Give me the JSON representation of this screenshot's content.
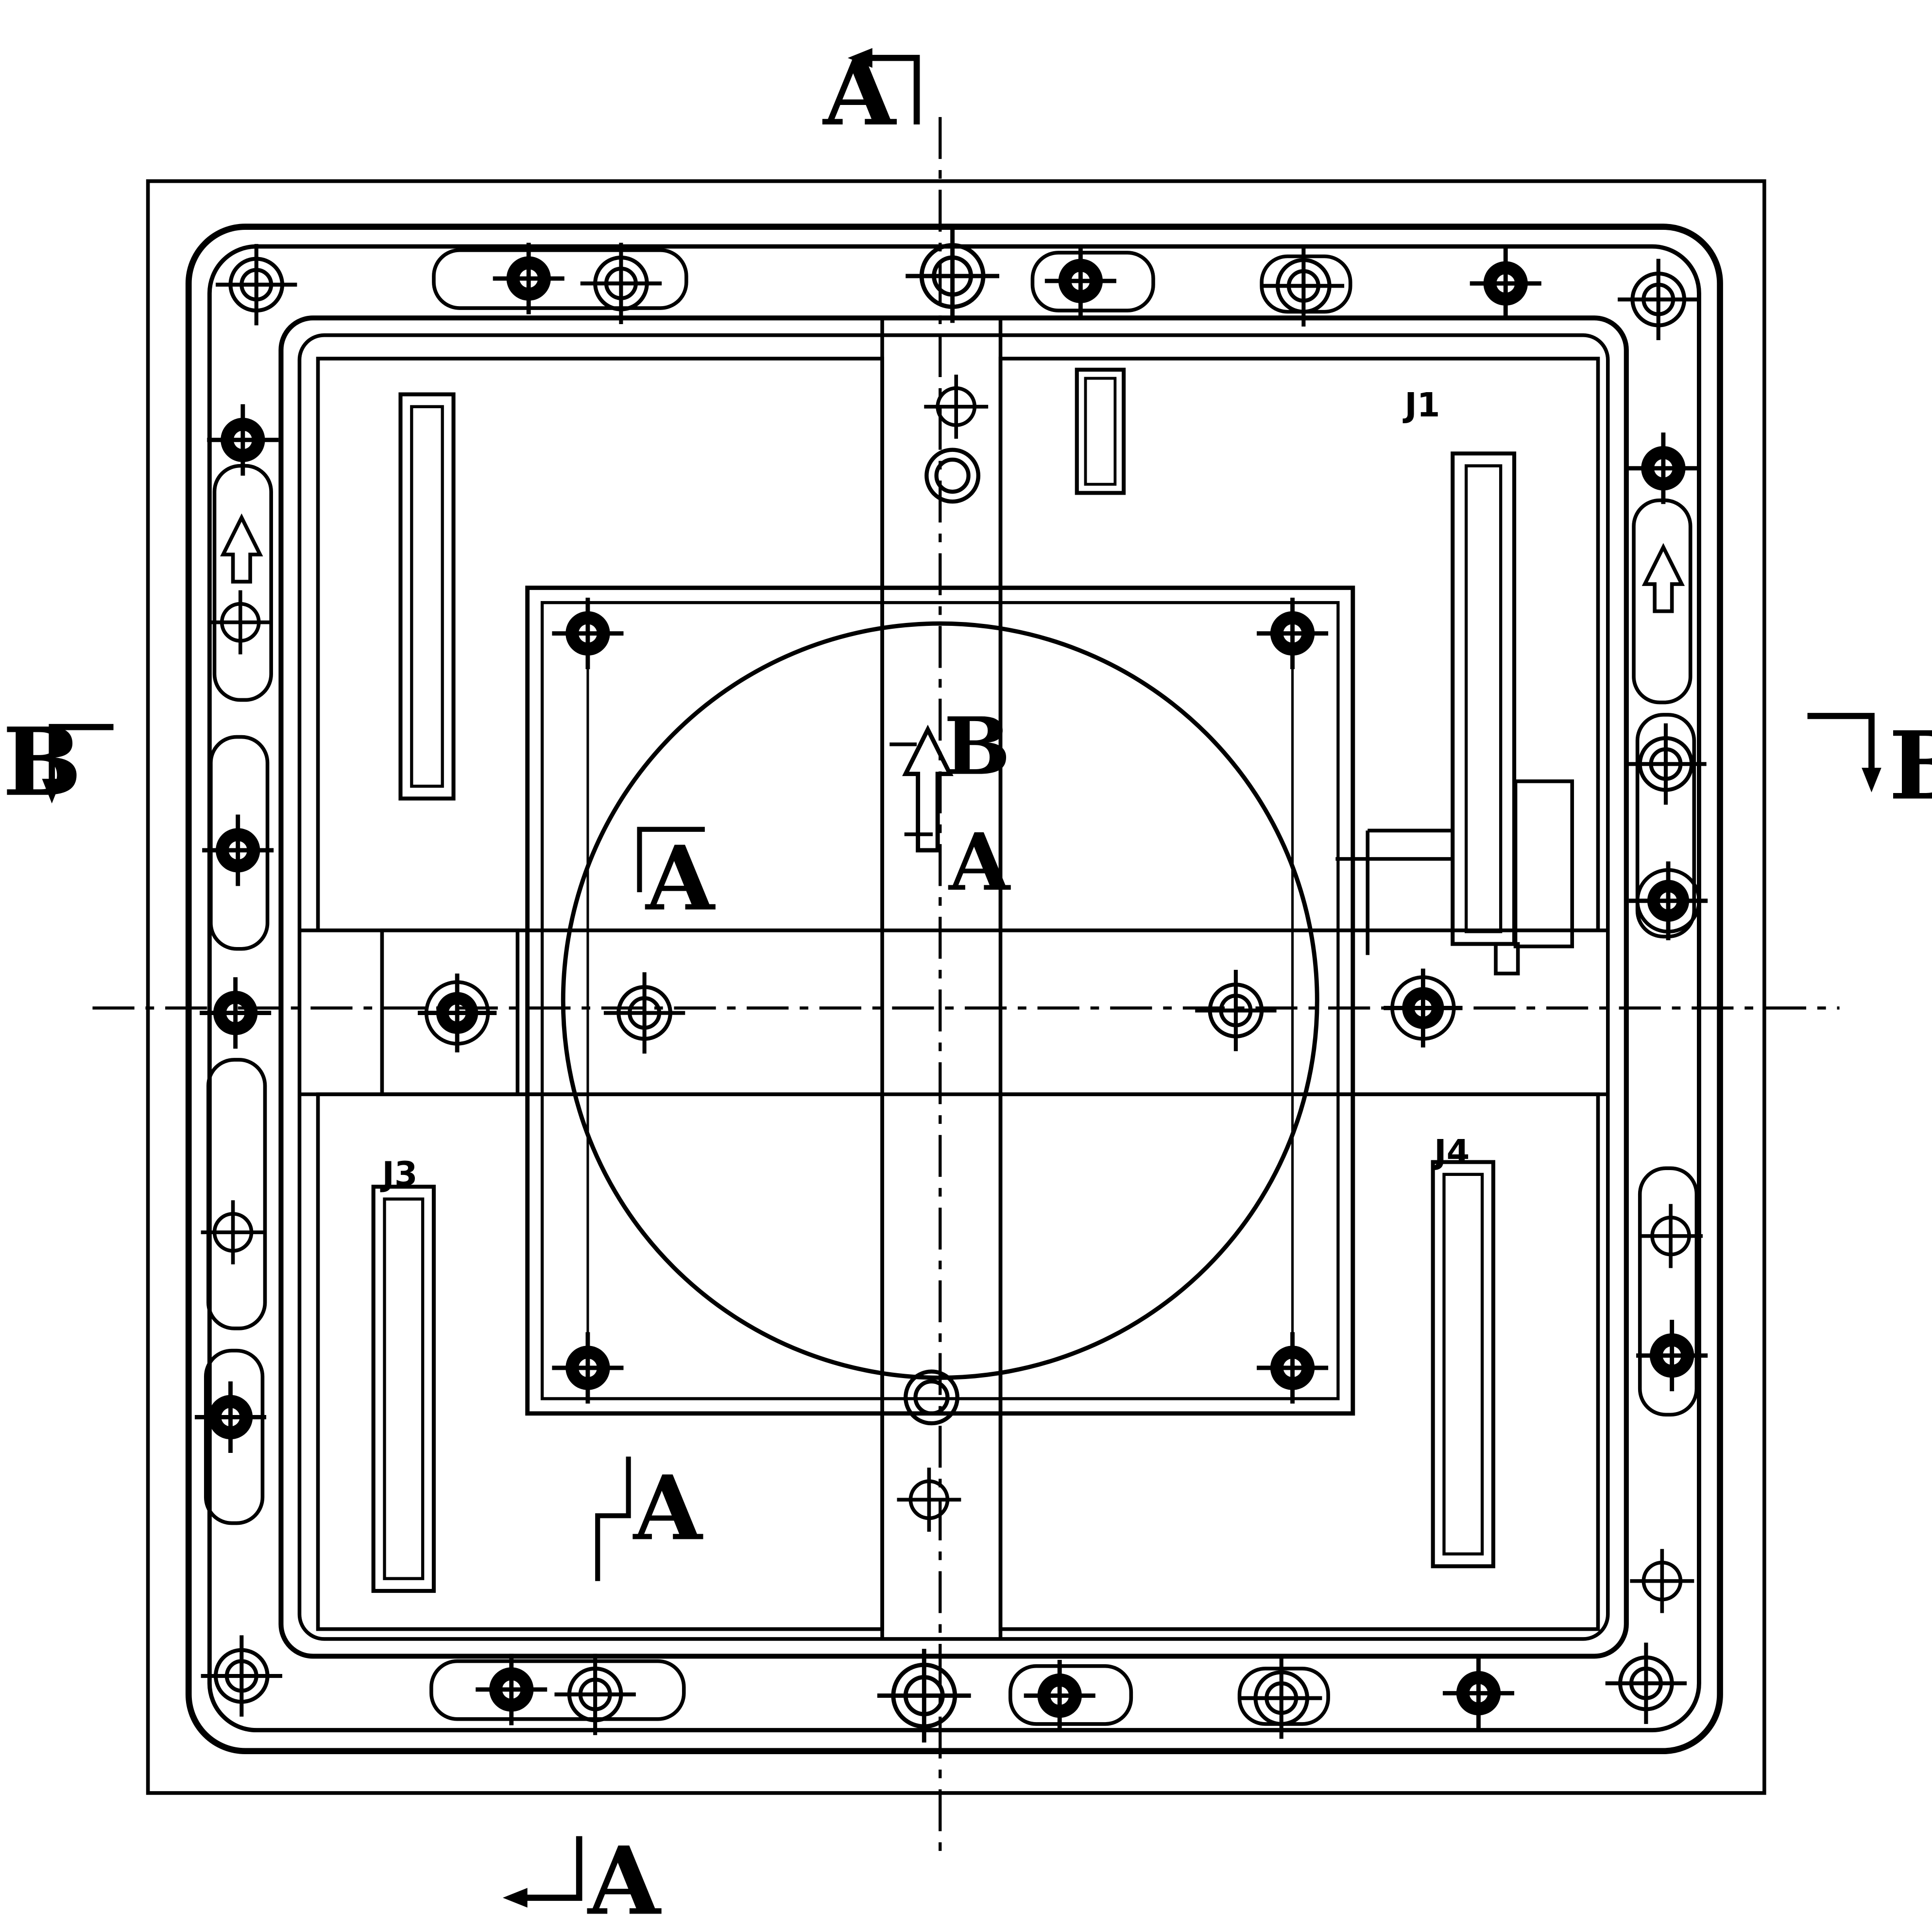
{
  "drawing": {
    "kind": "scanned engineering plan view of square mounting plate",
    "paper_color": "#ffffff",
    "ink_color": "#000000"
  },
  "annotations": {
    "section_top": "A",
    "section_bottom": "A",
    "section_left": "B",
    "section_right": "B",
    "section_center_b": "B",
    "section_center_a": "A",
    "section_mid_upper": "A",
    "section_mid_lower": "A",
    "label_j1": "J1",
    "label_j3": "J3",
    "label_j4": "J4"
  },
  "features": {
    "frames": [
      "outer-border",
      "outer-rounded-frame",
      "inner-rounded-frame"
    ],
    "holes": [
      "open-crosshair-hole",
      "filled-crosshair-hole",
      "small-crosshair-hole",
      "plain-ring-hole"
    ],
    "slots": [
      "top-left-slot",
      "right-slot",
      "bottom-left-slot",
      "bottom-right-slot",
      "small-top-rect"
    ],
    "symbols": [
      "hollow-up-arrow",
      "section-cut-bracket",
      "dash-dot-centerline"
    ]
  }
}
